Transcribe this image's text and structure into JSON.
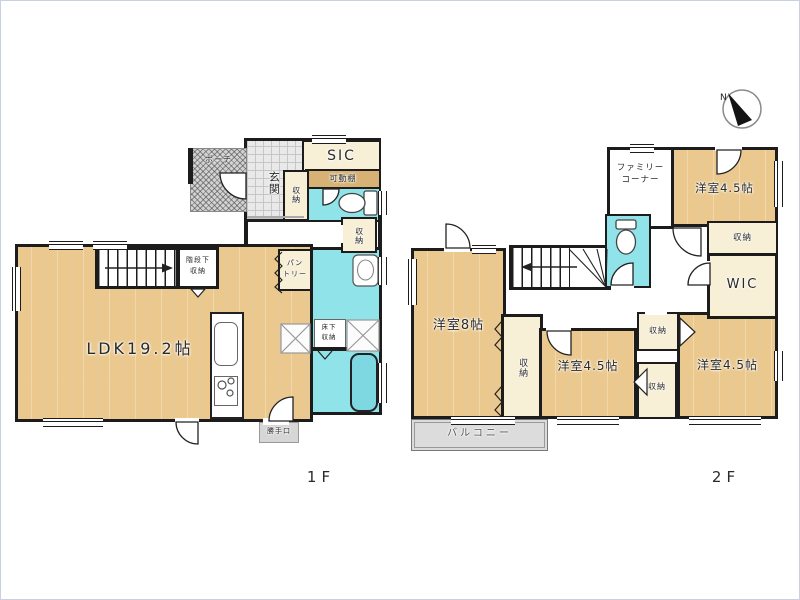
{
  "compass": {
    "label": "N"
  },
  "colors": {
    "wood_floor": "#ebc98e",
    "wet_area": "#8fe3e9",
    "closet": "#f7efd6",
    "movable_shelf": "#d8b175",
    "porch": "#d2d2d2",
    "balcony": "#dcdcdc",
    "wall": "#1c1c1c"
  },
  "floor1": {
    "label": "1F",
    "rooms": {
      "porch": "ポーチ",
      "genkan": "玄関",
      "sic": "SIC",
      "kadoudana": "可動棚",
      "shuno_genkan": "収納",
      "shuno_hall": "収納",
      "pantry_line1": "パン",
      "pantry_line2": "トリー",
      "kaidanshita_line1": "階段下",
      "kaidanshita_line2": "収納",
      "ldk": "LDK19.2帖",
      "yukashita_line1": "床下",
      "yukashita_line2": "収納",
      "katteguchi": "勝手口"
    }
  },
  "floor2": {
    "label": "2F",
    "rooms": {
      "family_line1": "ファミリー",
      "family_line2": "コーナー",
      "yoshitsu45_top": "洋室4.5帖",
      "shuno_top_right": "収納",
      "wic": "WIC",
      "yoshitsu8": "洋室8帖",
      "shuno_center": "収納",
      "yoshitsu45_center": "洋室4.5帖",
      "shuno_right_upper": "収納",
      "shuno_right_lower": "収納",
      "yoshitsu45_bottom": "洋室4.5帖",
      "balcony": "バルコニー"
    }
  }
}
